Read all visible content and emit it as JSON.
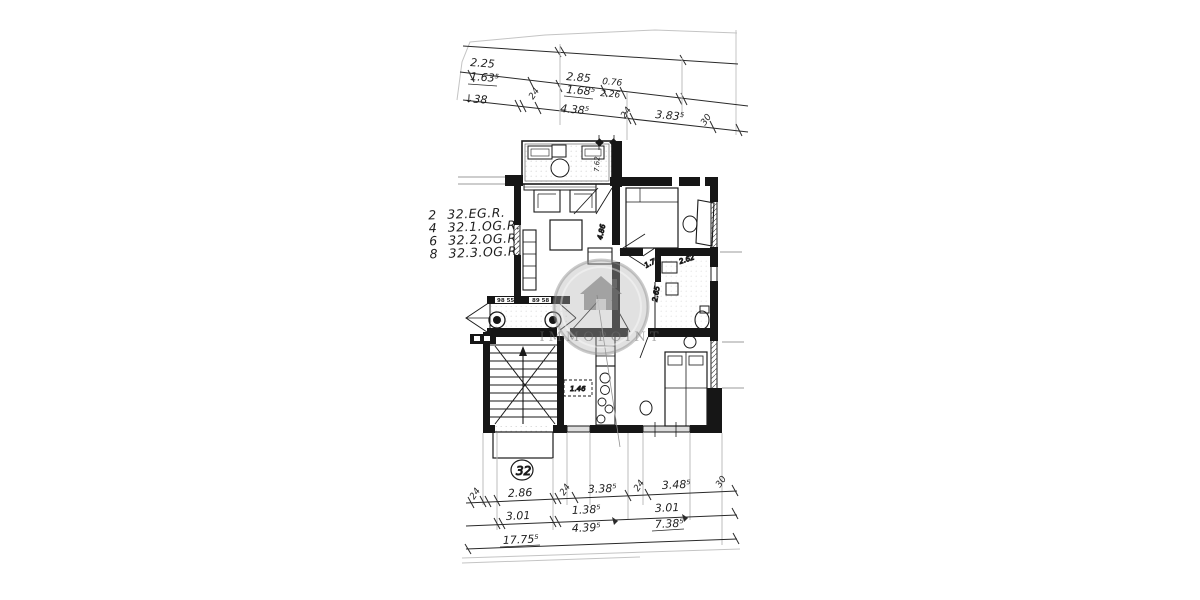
{
  "colors": {
    "ink": "#1a1a1a",
    "paper": "#ffffff",
    "scan_line": "#c4c4c4",
    "watermark_gray": "#9a9a9a"
  },
  "legend": {
    "rows": [
      {
        "num": "2",
        "label": "32.EG.R."
      },
      {
        "num": "4",
        "label": "32.1.OG.R."
      },
      {
        "num": "6",
        "label": "32.2.OG.R."
      },
      {
        "num": "8",
        "label": "32.3.OG.R."
      }
    ]
  },
  "top_dims": {
    "seg1_top": "2.25",
    "seg1_bot": "1.63⁵",
    "arrow_38": "↓38",
    "seg2_top": "2.85",
    "seg2_bot": "1.68⁵",
    "seg3_top": "0.76",
    "seg3_bot": "2.26",
    "tick24_a": "24",
    "seg4": "4.38⁵",
    "tick24_b": "24",
    "seg5": "3.83⁵",
    "tick30": "30"
  },
  "bottom_dims": {
    "row1": {
      "t24a": "24",
      "d1": "2.86",
      "t24b": "24",
      "d2": "3.38⁵",
      "t24c": "24",
      "d3": "3.48⁵",
      "t30": "30"
    },
    "row2": {
      "d1": "3.01",
      "d2_top": "1.38⁵",
      "d2_bot": "4.39⁵",
      "d3_top": "3.01",
      "d3_bot": "7.38⁵"
    },
    "total": "17.75⁵"
  },
  "plan": {
    "unit_number": "32",
    "porch_left": "98 55",
    "porch_right": "89 58",
    "balcony_door": "7.62",
    "living_width": "4.86",
    "bath_a": "1.76",
    "bath_b": "2.62",
    "bath_c": "2.65",
    "kitchen_box": "1.46"
  },
  "watermark": {
    "text": "IMMOPOINT"
  }
}
